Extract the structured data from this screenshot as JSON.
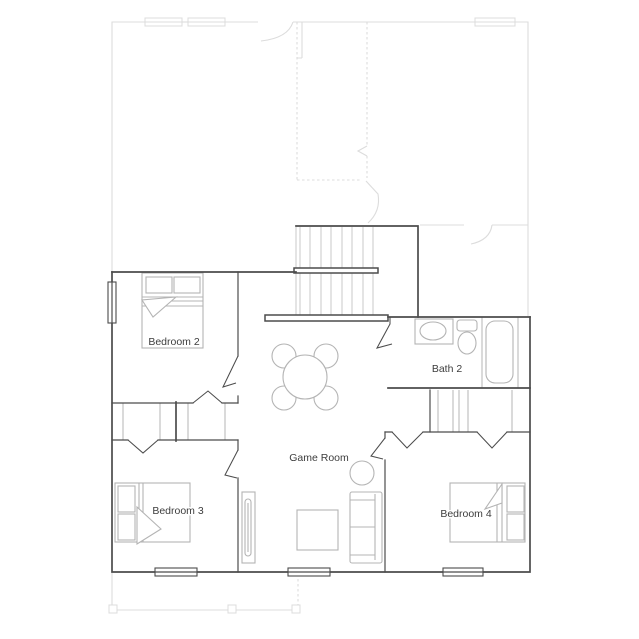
{
  "rooms": {
    "bedroom2": {
      "label": "Bedroom 2"
    },
    "bedroom3": {
      "label": "Bedroom 3"
    },
    "bedroom4": {
      "label": "Bedroom 4"
    },
    "bath2": {
      "label": "Bath 2"
    },
    "gameroom": {
      "label": "Game Room"
    }
  },
  "fixtures": {
    "bedroom2": [
      "bed"
    ],
    "bedroom3": [
      "bed"
    ],
    "bedroom4": [
      "bed"
    ],
    "bath2": [
      "sink",
      "toilet",
      "bathtub"
    ],
    "gameroom": [
      "round-table-with-four-chairs",
      "side-table",
      "sofa",
      "ottoman",
      "console-table"
    ],
    "hall": [
      "staircase"
    ]
  },
  "colors": {
    "wall": "#4c4c4c",
    "fixture": "#b4b4b4",
    "ghost": "#dcdcdc",
    "tread": "#c8c8c8",
    "text": "#3d3d3d",
    "bg": "#ffffff"
  }
}
